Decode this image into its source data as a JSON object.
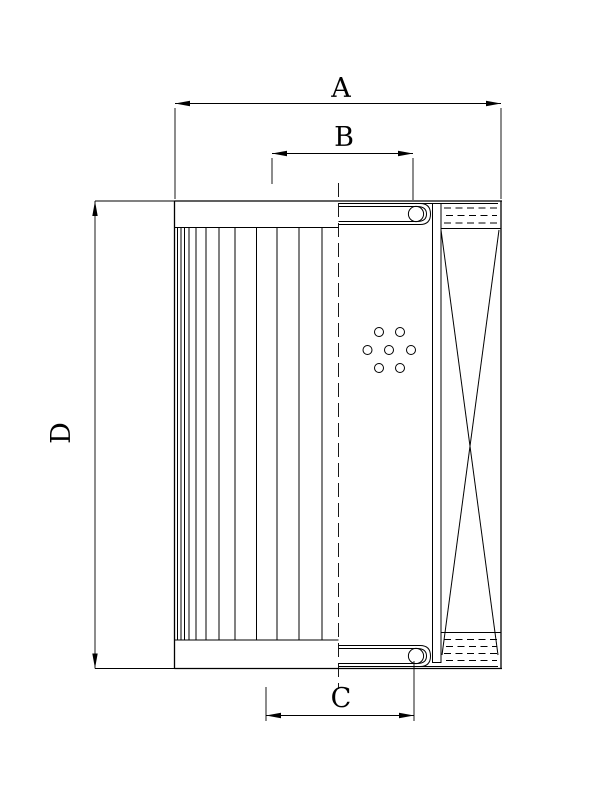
{
  "dimensions": {
    "A": {
      "label": "A"
    },
    "B": {
      "label": "B"
    },
    "C": {
      "label": "C"
    },
    "D": {
      "label": "D"
    }
  },
  "colors": {
    "ink": "#000000",
    "paper": "#ffffff"
  }
}
